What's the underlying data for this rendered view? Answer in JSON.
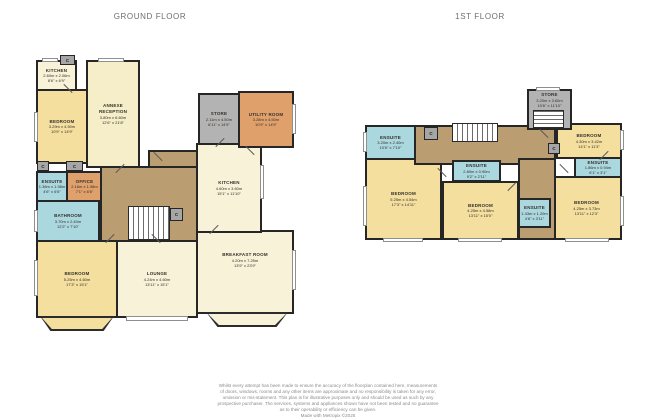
{
  "titles": {
    "ground_floor": "GROUND FLOOR",
    "first_floor": "1ST FLOOR"
  },
  "closet_label": "C",
  "colors": {
    "bedroom_fill": "#f4df9f",
    "living_fill": "#f8f2d8",
    "wet_room_fill": "#abd7df",
    "service_fill": "#e0a06c",
    "store_fill": "#b3b3b3",
    "hall_fill": "#bb9d72",
    "wall": "#262626"
  },
  "ground_floor": {
    "rooms": {
      "kitchen_annexe": {
        "name": "KITCHEN",
        "dim_m": "2.60m x 2.06m",
        "dim_ft": "8'6\" x 6'9\""
      },
      "bedroom_annexe": {
        "name": "BEDROOM",
        "dim_m": "3.29m x 4.50m",
        "dim_ft": "10'9\" x 14'9\""
      },
      "annexe_reception": {
        "name": "ANNEXE RECEPTION",
        "dim_m": "3.80m x 6.60m",
        "dim_ft": "12'6\" x 21'8\""
      },
      "ensuite": {
        "name": "ENSUITE",
        "dim_m": "1.36m x 1.98m",
        "dim_ft": "4'6\" x 6'6\""
      },
      "office": {
        "name": "OFFICE",
        "dim_m": "2.16m x 1.98m",
        "dim_ft": "7'1\" x 6'6\""
      },
      "bathroom": {
        "name": "BATHROOM",
        "dim_m": "3.70m x 2.40m",
        "dim_ft": "12'2\" x 7'10\""
      },
      "bedroom": {
        "name": "BEDROOM",
        "dim_m": "5.25m x 4.60m",
        "dim_ft": "17'3\" x 15'1\""
      },
      "lounge": {
        "name": "LOUNGE",
        "dim_m": "4.24m x 4.60m",
        "dim_ft": "13'11\" x 15'1\""
      },
      "breakfast_room": {
        "name": "BREAKFAST ROOM",
        "dim_m": "4.20m x 7.25m",
        "dim_ft": "13'9\" x 23'9\""
      },
      "kitchen": {
        "name": "KITCHEN",
        "dim_m": "4.60m x 3.60m",
        "dim_ft": "15'1\" x 11'10\""
      },
      "utility_room": {
        "name": "UTILITY ROOM",
        "dim_m": "3.28m x 4.50m",
        "dim_ft": "10'9\" x 14'9\""
      },
      "store": {
        "name": "STORE",
        "dim_m": "2.11m x 4.50m",
        "dim_ft": "6'11\" x 14'9\""
      }
    }
  },
  "first_floor": {
    "rooms": {
      "ensuite_left": {
        "name": "ENSUITE",
        "dim_m": "3.20m x 2.40m",
        "dim_ft": "10'6\" x 7'10\""
      },
      "bedroom_left": {
        "name": "BEDROOM",
        "dim_m": "5.25m x 4.54m",
        "dim_ft": "17'3\" x 14'11\""
      },
      "ensuite_middle": {
        "name": "ENSUITE",
        "dim_m": "2.80m x 0.90m",
        "dim_ft": "9'2\" x 2'11\""
      },
      "bedroom_middle": {
        "name": "BEDROOM",
        "dim_m": "4.25m x 4.58m",
        "dim_ft": "13'11\" x 15'0\""
      },
      "ensuite_inner": {
        "name": "ENSUITE",
        "dim_m": "1.43m x 1.20m",
        "dim_ft": "4'8\" x 3'11\""
      },
      "bedroom_top_right": {
        "name": "BEDROOM",
        "dim_m": "4.30m x 3.42m",
        "dim_ft": "14'1\" x 11'3\""
      },
      "ensuite_right": {
        "name": "ENSUITE",
        "dim_m": "1.86m x 0.94m",
        "dim_ft": "6'1\" x 3'1\""
      },
      "bedroom_bottom_right": {
        "name": "BEDROOM",
        "dim_m": "4.25m x 3.73m",
        "dim_ft": "13'11\" x 12'3\""
      },
      "store": {
        "name": "STORE",
        "dim_m": "3.20m x 3.60m",
        "dim_ft": "10'6\" x 11'10\""
      }
    }
  },
  "footer": {
    "lines": [
      "Whilst every attempt has been made to ensure the accuracy of the floorplan contained here, measurements",
      "of doors, windows, rooms and any other items are approximate and no responsibility is taken for any error,",
      "omission or mis-statement. This plan is for illustrative purposes only and should be used as such by any",
      "prospective purchaser. The services, systems and appliances shown have not been tested and no guarantee",
      "as to their operability or efficiency can be given.",
      "Made with Metropix ©2025"
    ]
  }
}
